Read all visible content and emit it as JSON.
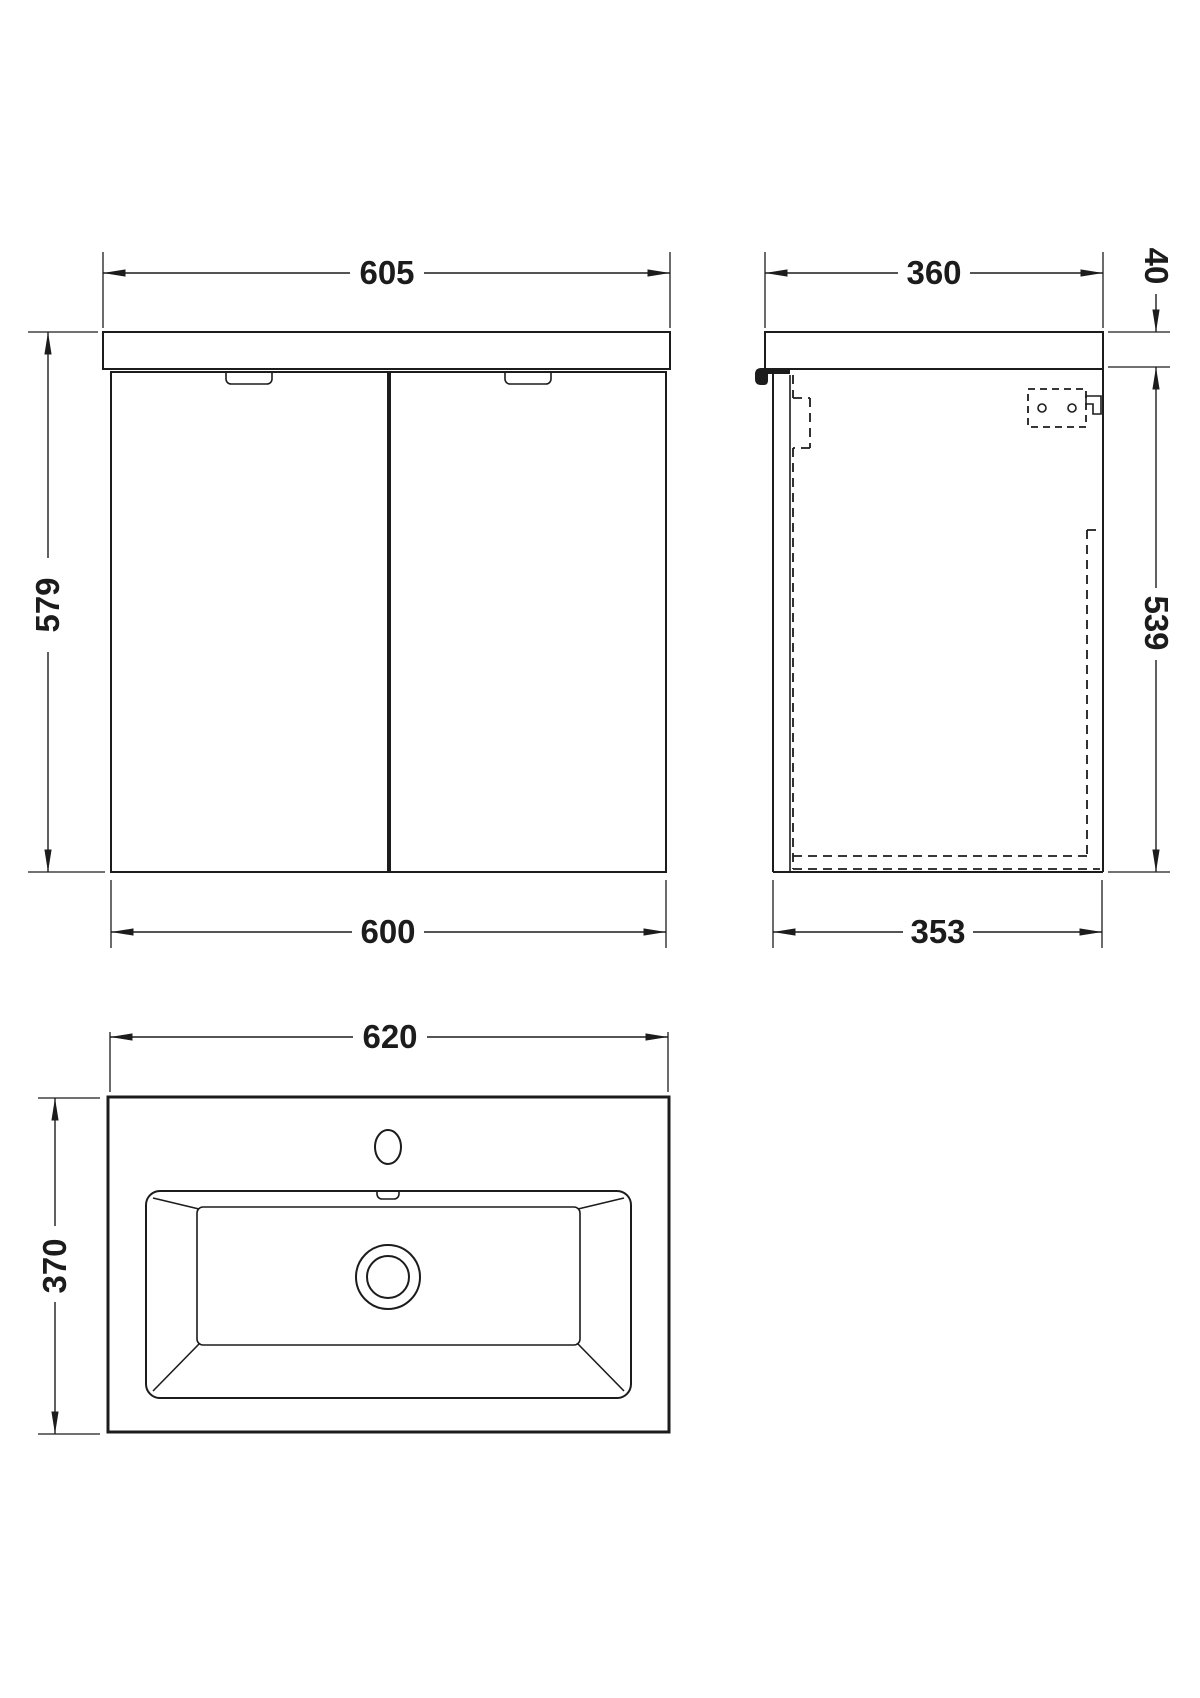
{
  "drawing": {
    "front_view": {
      "width_top": "605",
      "height": "579",
      "width_bottom": "600"
    },
    "side_view": {
      "depth_top": "360",
      "worktop_thickness": "40",
      "cabinet_height": "539",
      "depth_bottom": "353"
    },
    "basin_view": {
      "width": "620",
      "depth": "370"
    }
  },
  "colors": {
    "line": "#1c1c1c",
    "background": "#ffffff"
  }
}
